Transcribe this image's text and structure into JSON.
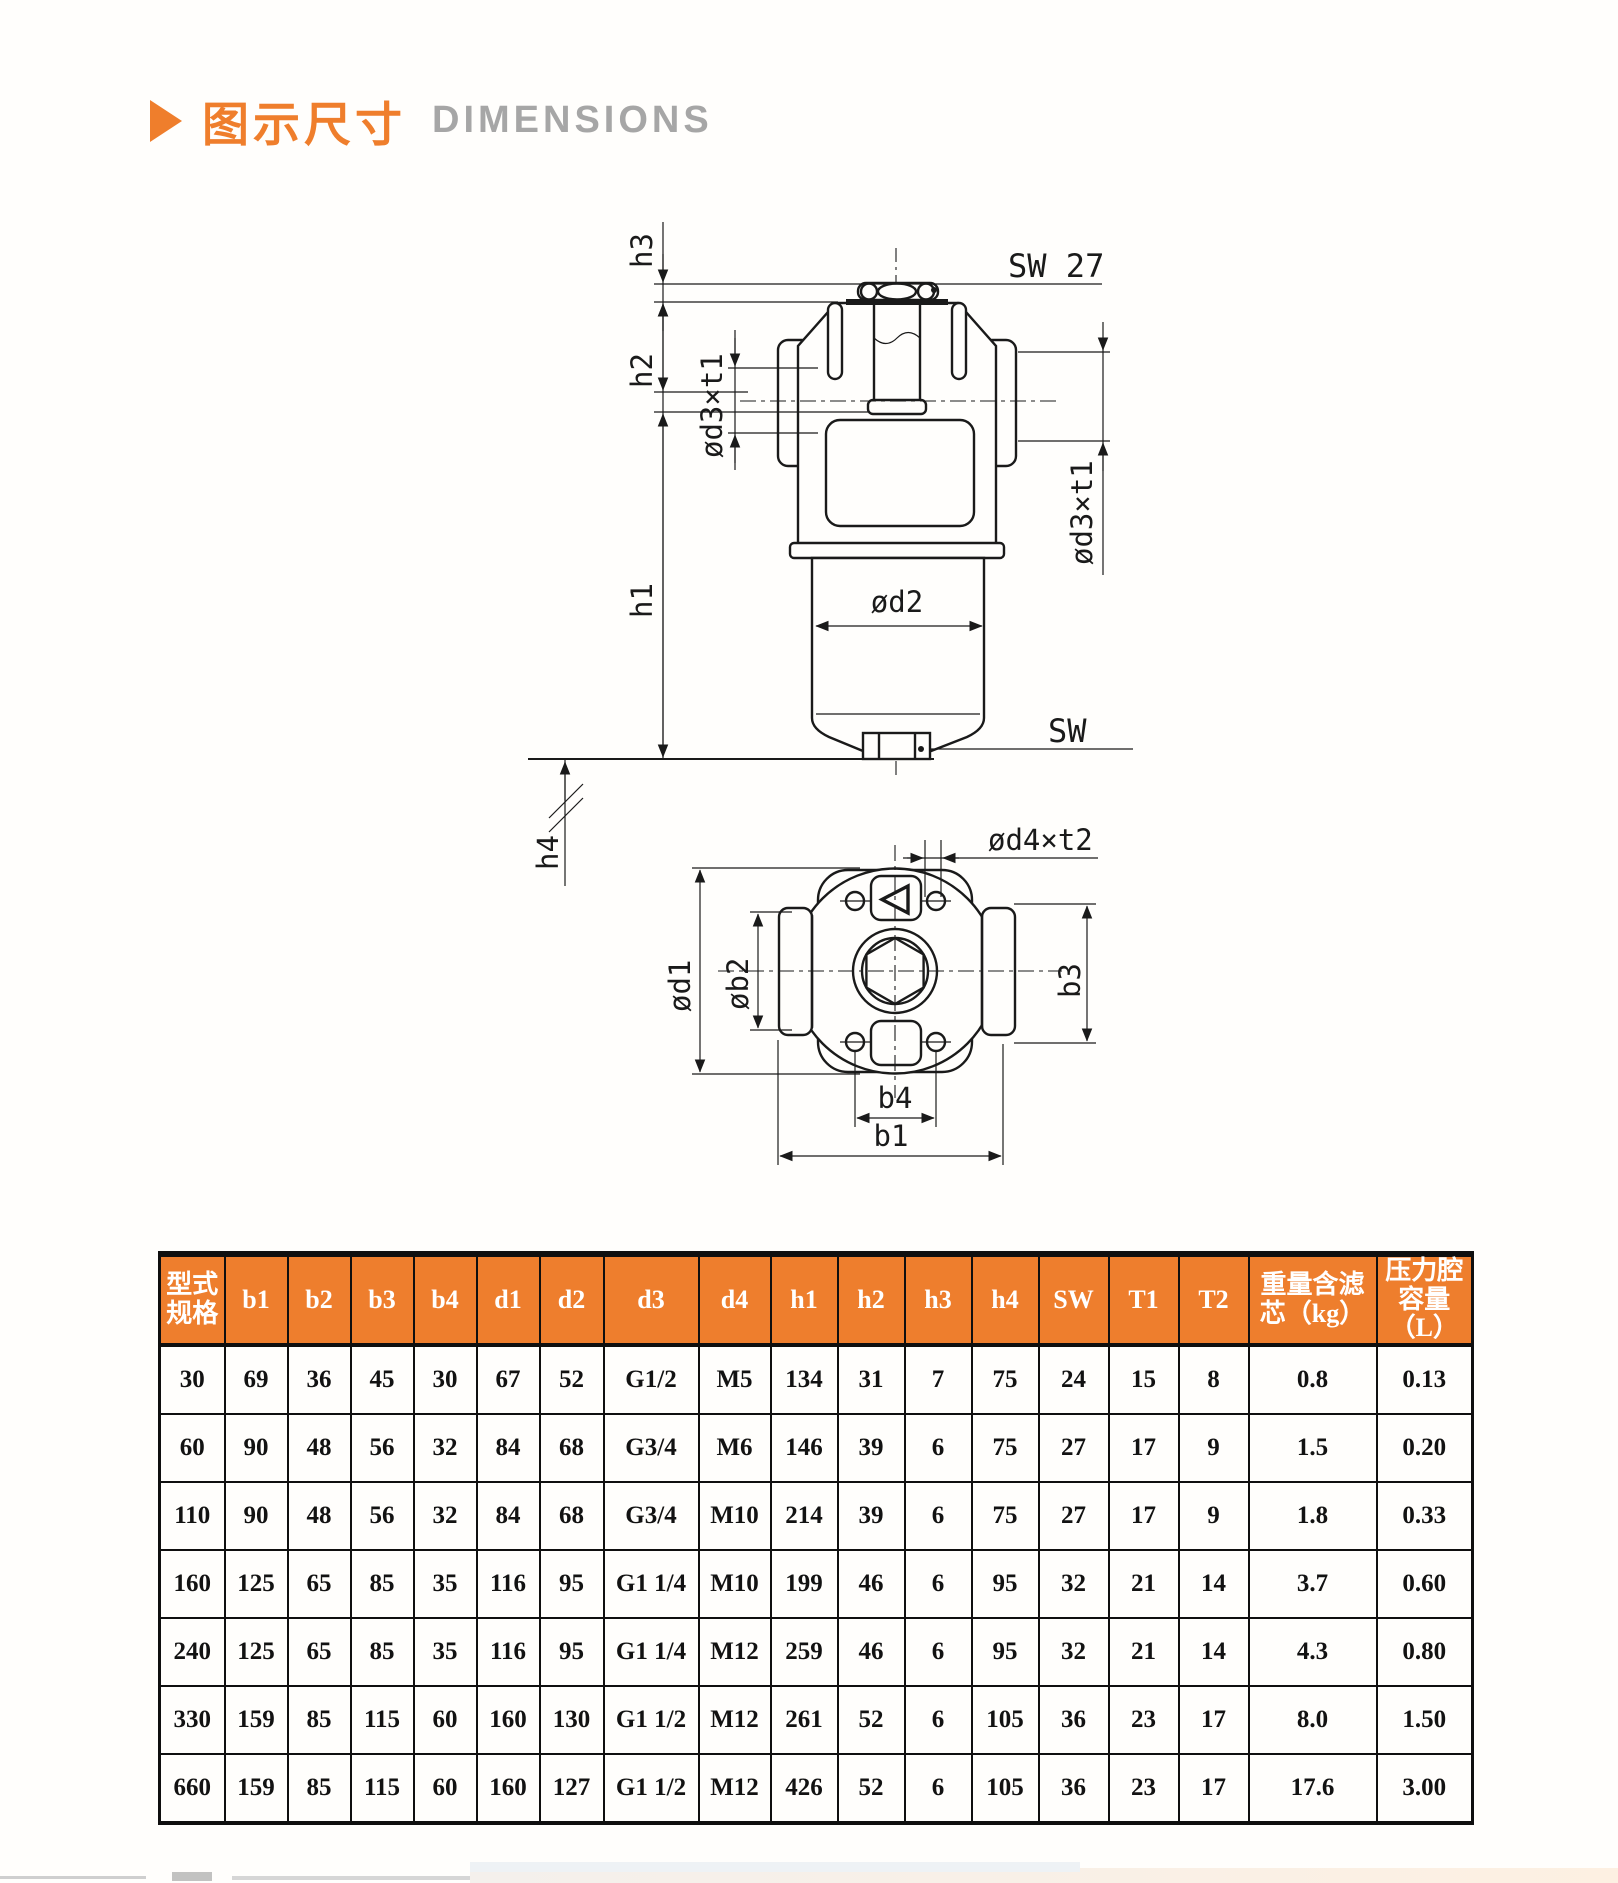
{
  "header": {
    "title_zh": "图示尺寸",
    "title_en": "DIMENSIONS"
  },
  "colors": {
    "accent_orange": "#ee7e2d",
    "title_gray": "#a6a6a6",
    "line": "#1a1a1a"
  },
  "drawing": {
    "front_labels": {
      "h3": "h3",
      "h2": "h2",
      "h1": "h1",
      "h4": "h4",
      "sw27": "SW 27",
      "sw": "SW",
      "od3t1_left": "ød3×t1",
      "od3t1_right": "ød3×t1",
      "od2": "ød2"
    },
    "bottom_labels": {
      "od4t2": "ød4×t2",
      "od1": "ød1",
      "ob2": "øb2",
      "b3": "b3",
      "b4": "b4",
      "b1": "b1"
    }
  },
  "table": {
    "headers": [
      "型式\n规格",
      "b1",
      "b2",
      "b3",
      "b4",
      "d1",
      "d2",
      "d3",
      "d4",
      "h1",
      "h2",
      "h3",
      "h4",
      "SW",
      "T1",
      "T2",
      "重量含滤\n芯（kg）",
      "压力腔\n容量（L）"
    ],
    "col_widths": [
      65,
      63,
      63,
      63,
      63,
      63,
      64,
      95,
      72,
      67,
      67,
      67,
      67,
      70,
      70,
      70,
      128,
      96
    ],
    "rows": [
      [
        "30",
        "69",
        "36",
        "45",
        "30",
        "67",
        "52",
        "G1/2",
        "M5",
        "134",
        "31",
        "7",
        "75",
        "24",
        "15",
        "8",
        "0.8",
        "0.13"
      ],
      [
        "60",
        "90",
        "48",
        "56",
        "32",
        "84",
        "68",
        "G3/4",
        "M6",
        "146",
        "39",
        "6",
        "75",
        "27",
        "17",
        "9",
        "1.5",
        "0.20"
      ],
      [
        "110",
        "90",
        "48",
        "56",
        "32",
        "84",
        "68",
        "G3/4",
        "M10",
        "214",
        "39",
        "6",
        "75",
        "27",
        "17",
        "9",
        "1.8",
        "0.33"
      ],
      [
        "160",
        "125",
        "65",
        "85",
        "35",
        "116",
        "95",
        "G1 1/4",
        "M10",
        "199",
        "46",
        "6",
        "95",
        "32",
        "21",
        "14",
        "3.7",
        "0.60"
      ],
      [
        "240",
        "125",
        "65",
        "85",
        "35",
        "116",
        "95",
        "G1 1/4",
        "M12",
        "259",
        "46",
        "6",
        "95",
        "32",
        "21",
        "14",
        "4.3",
        "0.80"
      ],
      [
        "330",
        "159",
        "85",
        "115",
        "60",
        "160",
        "130",
        "G1 1/2",
        "M12",
        "261",
        "52",
        "6",
        "105",
        "36",
        "23",
        "17",
        "8.0",
        "1.50"
      ],
      [
        "660",
        "159",
        "85",
        "115",
        "60",
        "160",
        "127",
        "G1 1/2",
        "M12",
        "426",
        "52",
        "6",
        "105",
        "36",
        "23",
        "17",
        "17.6",
        "3.00"
      ]
    ]
  }
}
